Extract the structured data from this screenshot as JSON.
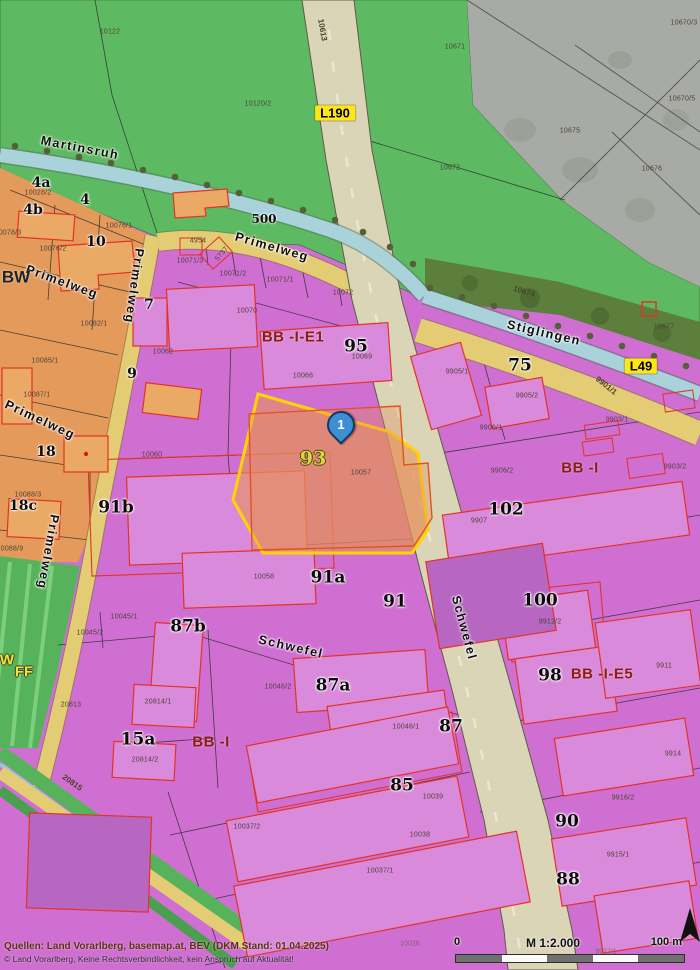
{
  "map": {
    "marker": {
      "label": "1"
    },
    "selected_parcel": {
      "number": "93",
      "parcel_id": "10057",
      "highlight_color": "#ffd400"
    },
    "colors": {
      "zone_business": "#cf6fd2",
      "zone_residential": "#e49a5a",
      "zone_open_green": "#5eba62",
      "zone_forest": "#5c7f3e",
      "road_major": "#dbd5b8",
      "road_minor": "#e3cc74",
      "stream": "#a9d2db",
      "building_outline": "#e43224",
      "marker_blue": "#3e8ed6"
    },
    "labels": [
      {
        "t": "10122",
        "x": 110,
        "y": 32,
        "c": "pn"
      },
      {
        "t": "10613",
        "x": 322,
        "y": 30,
        "r": 80,
        "c": "road"
      },
      {
        "t": "10120/2",
        "x": 258,
        "y": 104,
        "c": "pn"
      },
      {
        "t": "10671",
        "x": 455,
        "y": 47,
        "c": "pn"
      },
      {
        "t": "10670/3",
        "x": 684,
        "y": 23,
        "c": "pn"
      },
      {
        "t": "10670/5",
        "x": 682,
        "y": 99,
        "c": "pn"
      },
      {
        "t": "10675",
        "x": 570,
        "y": 131,
        "c": "pn"
      },
      {
        "t": "10672",
        "x": 450,
        "y": 168,
        "c": "pn"
      },
      {
        "t": "10676",
        "x": 652,
        "y": 169,
        "c": "pn"
      },
      {
        "t": "L190",
        "x": 335,
        "y": 113,
        "c": "roadbox"
      },
      {
        "t": "L49",
        "x": 641,
        "y": 366,
        "c": "roadbox"
      },
      {
        "t": "Martinsruh",
        "x": 80,
        "y": 148,
        "r": 11,
        "c": "street"
      },
      {
        "t": "500",
        "x": 264,
        "y": 219,
        "c": "addr-sm"
      },
      {
        "t": "Primelweg",
        "x": 272,
        "y": 247,
        "r": 16,
        "c": "street"
      },
      {
        "t": "Primelweg",
        "x": 62,
        "y": 282,
        "r": 20,
        "c": "street"
      },
      {
        "t": "Primelweg",
        "x": 134,
        "y": 286,
        "r": 98,
        "c": "street"
      },
      {
        "t": "Primelweg",
        "x": 40,
        "y": 420,
        "r": 25,
        "c": "street"
      },
      {
        "t": "Primelweg",
        "x": 48,
        "y": 552,
        "r": 100,
        "c": "street"
      },
      {
        "t": "Stiglingen",
        "x": 544,
        "y": 333,
        "r": 13,
        "c": "street"
      },
      {
        "t": "Schwefel",
        "x": 291,
        "y": 647,
        "r": 13,
        "c": "street"
      },
      {
        "t": "Schwefel",
        "x": 464,
        "y": 628,
        "r": 75,
        "c": "street"
      },
      {
        "t": "10674",
        "x": 524,
        "y": 292,
        "r": 17,
        "c": "road"
      },
      {
        "t": "10677",
        "x": 664,
        "y": 327,
        "c": "pn"
      },
      {
        "t": "9901/1",
        "x": 606,
        "y": 386,
        "r": 38,
        "c": "road"
      },
      {
        "t": "20815",
        "x": 72,
        "y": 783,
        "r": 35,
        "c": "road"
      },
      {
        "t": "4a",
        "x": 41,
        "y": 183,
        "c": "addr"
      },
      {
        "t": "10028/2",
        "x": 38,
        "y": 193,
        "c": "pn"
      },
      {
        "t": "4",
        "x": 85,
        "y": 200,
        "c": "addr"
      },
      {
        "t": "4b",
        "x": 33,
        "y": 210,
        "c": "addr"
      },
      {
        "t": "10076/1",
        "x": 119,
        "y": 226,
        "c": "pn"
      },
      {
        "t": "10",
        "x": 96,
        "y": 242,
        "c": "addr"
      },
      {
        "t": "10076/2",
        "x": 53,
        "y": 249,
        "c": "pn"
      },
      {
        "t": "10078/3",
        "x": 8,
        "y": 233,
        "c": "pn"
      },
      {
        "t": "BW",
        "x": 16,
        "y": 277,
        "c": "zone-dk"
      },
      {
        "t": "10082/1",
        "x": 94,
        "y": 324,
        "c": "pn"
      },
      {
        "t": "10085/1",
        "x": 45,
        "y": 361,
        "c": "pn"
      },
      {
        "t": "10087/1",
        "x": 37,
        "y": 395,
        "c": "pn"
      },
      {
        "t": "18",
        "x": 46,
        "y": 452,
        "c": "addr"
      },
      {
        "t": "10088/3",
        "x": 28,
        "y": 495,
        "c": "pn"
      },
      {
        "t": "18c",
        "x": 23,
        "y": 506,
        "c": "addr"
      },
      {
        "t": "10088/9",
        "x": 10,
        "y": 549,
        "c": "pn"
      },
      {
        "t": "7",
        "x": 149,
        "y": 305,
        "c": "addr"
      },
      {
        "t": "10062",
        "x": 163,
        "y": 352,
        "c": "pn"
      },
      {
        "t": "9",
        "x": 132,
        "y": 374,
        "c": "addr"
      },
      {
        "t": "4954",
        "x": 198,
        "y": 241,
        "c": "pn"
      },
      {
        "t": "5737",
        "x": 222,
        "y": 254,
        "r": -50,
        "c": "pn"
      },
      {
        "t": "10071/3",
        "x": 190,
        "y": 261,
        "c": "pn"
      },
      {
        "t": "10071/2",
        "x": 233,
        "y": 274,
        "c": "pn"
      },
      {
        "t": "10071/1",
        "x": 280,
        "y": 280,
        "c": "pn"
      },
      {
        "t": "10072",
        "x": 343,
        "y": 293,
        "c": "pn"
      },
      {
        "t": "10070",
        "x": 247,
        "y": 311,
        "c": "pn"
      },
      {
        "t": "BB -I-E1",
        "x": 293,
        "y": 337,
        "c": "zone"
      },
      {
        "t": "95",
        "x": 356,
        "y": 347,
        "c": "addr-lg"
      },
      {
        "t": "10069",
        "x": 362,
        "y": 357,
        "c": "pn"
      },
      {
        "t": "10066",
        "x": 303,
        "y": 376,
        "c": "pn"
      },
      {
        "t": "9905/1",
        "x": 457,
        "y": 372,
        "c": "pn"
      },
      {
        "t": "75",
        "x": 520,
        "y": 366,
        "c": "addr-lg"
      },
      {
        "t": "9905/2",
        "x": 527,
        "y": 396,
        "c": "pn"
      },
      {
        "t": "9906/1",
        "x": 491,
        "y": 428,
        "c": "pn"
      },
      {
        "t": "9906/2",
        "x": 502,
        "y": 471,
        "c": "pn"
      },
      {
        "t": "BB -I",
        "x": 580,
        "y": 468,
        "c": "zone"
      },
      {
        "t": "9903/1",
        "x": 617,
        "y": 420,
        "c": "pn"
      },
      {
        "t": "9903/2",
        "x": 675,
        "y": 467,
        "c": "pn"
      },
      {
        "t": "102",
        "x": 506,
        "y": 510,
        "c": "addr-lg"
      },
      {
        "t": "9907",
        "x": 479,
        "y": 521,
        "c": "pn"
      },
      {
        "t": "10060",
        "x": 152,
        "y": 455,
        "c": "pn"
      },
      {
        "t": "91b",
        "x": 116,
        "y": 508,
        "c": "addr-lg"
      },
      {
        "t": "93",
        "x": 313,
        "y": 459,
        "c": "sel-addr"
      },
      {
        "t": "10057",
        "x": 361,
        "y": 473,
        "c": "pn"
      },
      {
        "t": "10058",
        "x": 264,
        "y": 577,
        "c": "pn"
      },
      {
        "t": "91a",
        "x": 328,
        "y": 578,
        "c": "addr-lg"
      },
      {
        "t": "91",
        "x": 395,
        "y": 602,
        "c": "addr-lg"
      },
      {
        "t": "10045/1",
        "x": 124,
        "y": 617,
        "c": "pn"
      },
      {
        "t": "10045/2",
        "x": 90,
        "y": 633,
        "c": "pn"
      },
      {
        "t": "87b",
        "x": 188,
        "y": 627,
        "c": "addr-lg"
      },
      {
        "t": "10046/2",
        "x": 278,
        "y": 687,
        "c": "pn"
      },
      {
        "t": "87a",
        "x": 333,
        "y": 686,
        "c": "addr-lg"
      },
      {
        "t": "10046/1",
        "x": 406,
        "y": 727,
        "c": "pn"
      },
      {
        "t": "87",
        "x": 451,
        "y": 727,
        "c": "addr-lg"
      },
      {
        "t": "100",
        "x": 540,
        "y": 601,
        "c": "addr-lg"
      },
      {
        "t": "9912/2",
        "x": 550,
        "y": 622,
        "c": "pn"
      },
      {
        "t": "98",
        "x": 550,
        "y": 676,
        "c": "addr-lg"
      },
      {
        "t": "BB -I-E5",
        "x": 602,
        "y": 674,
        "c": "zone"
      },
      {
        "t": "9911",
        "x": 664,
        "y": 666,
        "c": "pn"
      },
      {
        "t": "W",
        "x": 7,
        "y": 660,
        "c": "zoneY"
      },
      {
        "t": "FF",
        "x": 24,
        "y": 672,
        "c": "zoneY"
      },
      {
        "t": "20813",
        "x": 71,
        "y": 705,
        "c": "pn"
      },
      {
        "t": "20814/1",
        "x": 158,
        "y": 702,
        "c": "pn"
      },
      {
        "t": "15a",
        "x": 138,
        "y": 740,
        "c": "addr-lg"
      },
      {
        "t": "20814/2",
        "x": 145,
        "y": 760,
        "c": "pn"
      },
      {
        "t": "BB -I",
        "x": 211,
        "y": 742,
        "c": "zone"
      },
      {
        "t": "85",
        "x": 402,
        "y": 786,
        "c": "addr-lg"
      },
      {
        "t": "10039",
        "x": 433,
        "y": 797,
        "c": "pn"
      },
      {
        "t": "10038",
        "x": 420,
        "y": 835,
        "c": "pn"
      },
      {
        "t": "10037/2",
        "x": 247,
        "y": 827,
        "c": "pn"
      },
      {
        "t": "10037/1",
        "x": 380,
        "y": 871,
        "c": "pn"
      },
      {
        "t": "9914",
        "x": 673,
        "y": 754,
        "c": "pn"
      },
      {
        "t": "9916/2",
        "x": 623,
        "y": 798,
        "c": "pn"
      },
      {
        "t": "90",
        "x": 567,
        "y": 822,
        "c": "addr-lg"
      },
      {
        "t": "9915/1",
        "x": 618,
        "y": 855,
        "c": "pn"
      },
      {
        "t": "88",
        "x": 568,
        "y": 880,
        "c": "addr-lg"
      },
      {
        "t": "10026",
        "x": 410,
        "y": 944,
        "c": "pnf"
      },
      {
        "t": "9927/1",
        "x": 606,
        "y": 952,
        "c": "pnf"
      }
    ]
  },
  "scalebar": {
    "zero": "0",
    "scale": "M 1:2.000",
    "max": "100 m"
  },
  "attribution": {
    "line1": "Quellen: Land Vorarlberg, basemap.at, BEV (DKM Stand: 01.04.2025)",
    "line2": "© Land Vorarlberg, Keine Rechtsverbindlichkeit, kein Anspruch auf Aktualität!"
  }
}
